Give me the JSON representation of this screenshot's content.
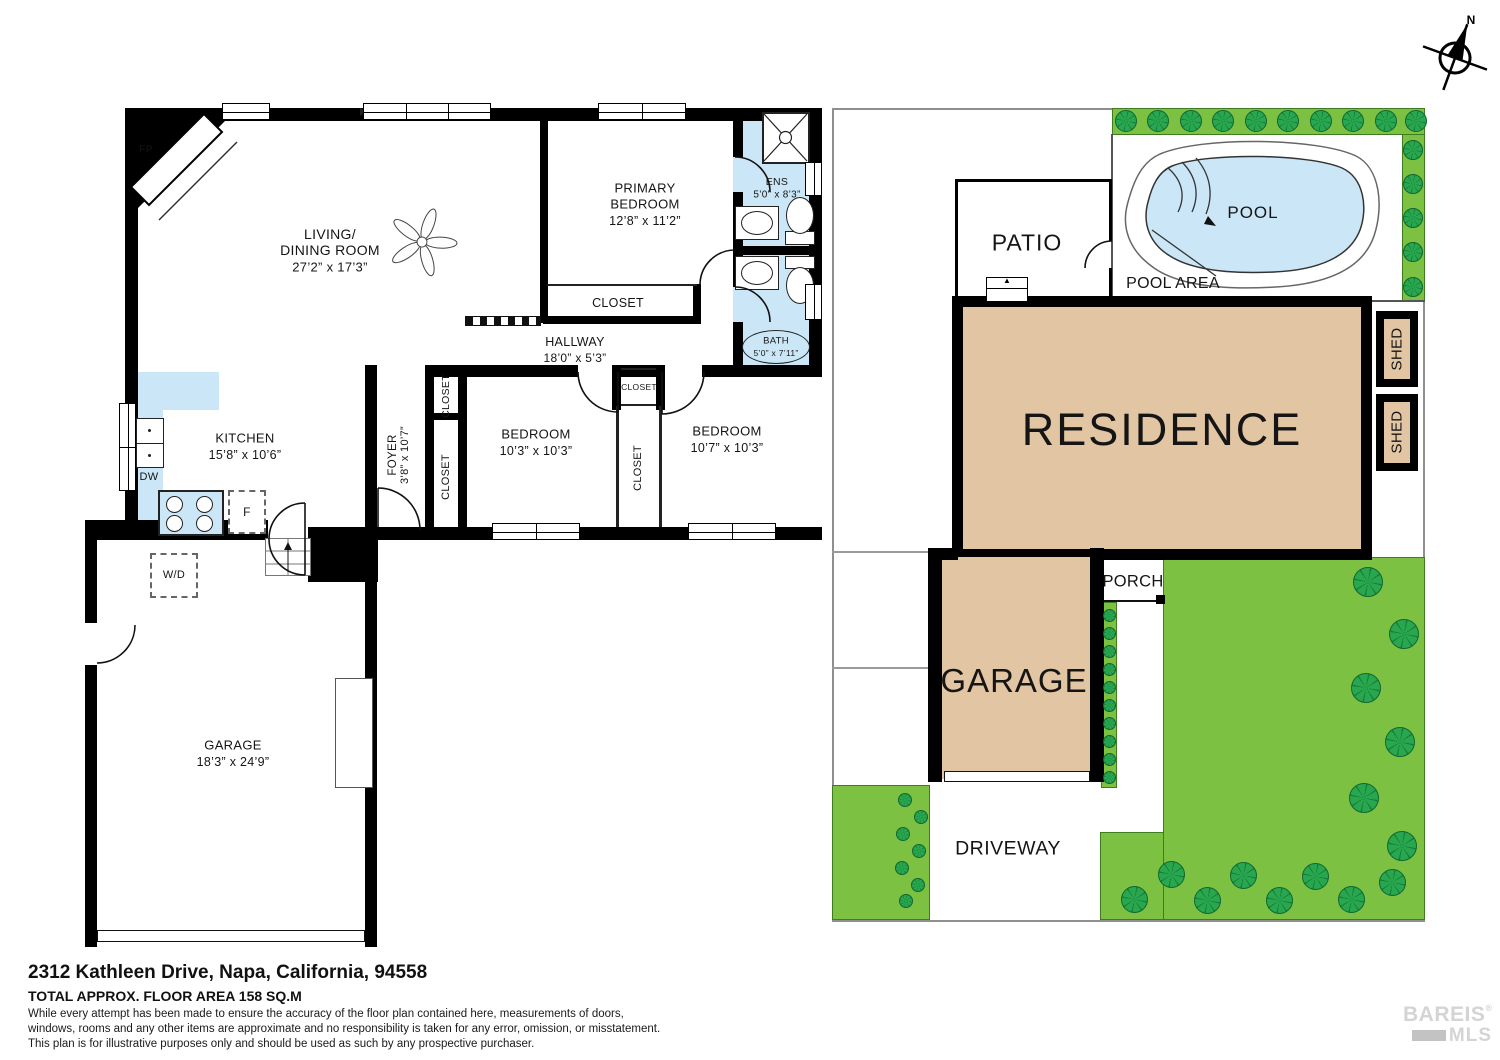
{
  "compass": {
    "north": "N"
  },
  "floorplan": {
    "fireplace": "FP",
    "living": {
      "l1": "LIVING/",
      "l2": "DINING ROOM",
      "dims": "27’2” x 17’3”"
    },
    "primary": {
      "l1": "PRIMARY",
      "l2": "BEDROOM",
      "dims": "12’8” x 11’2”"
    },
    "ens": {
      "name": "ENS",
      "dims": "5’0” x 8’3”"
    },
    "bath": {
      "name": "BATH",
      "dims": "5’0” x 7’11”"
    },
    "hallway": {
      "name": "HALLWAY",
      "dims": "18’0” x 5’3”"
    },
    "kitchen": {
      "name": "KITCHEN",
      "dims": "15’8” x 10’6”",
      "dishwasher": "DW",
      "fridge": "F"
    },
    "foyer": {
      "name": "FOYER",
      "dims": "3’8” x 10’7”"
    },
    "closet": "CLOSET",
    "bedroom1": {
      "name": "BEDROOM",
      "dims": "10’3” x 10’3”"
    },
    "bedroom2": {
      "name": "BEDROOM",
      "dims": "10’7” x 10’3”"
    },
    "washer_dryer": "W/D",
    "garage": {
      "name": "GARAGE",
      "dims": "18’3” x 24’9”"
    }
  },
  "siteplan": {
    "patio": "PATIO",
    "pool": "POOL",
    "pool_area": "POOL AREA",
    "residence": "RESIDENCE",
    "shed": "SHED",
    "porch": "PORCH",
    "garage": "GARAGE",
    "driveway": "DRIVEWAY"
  },
  "footer": {
    "address": "2312 Kathleen Drive, Napa, California, 94558",
    "area": "TOTAL APPROX. FLOOR AREA 158 SQ.M",
    "disclaimer": [
      "While  every attempt has been made to ensure the accuracy of the floor plan contained here, measurements of doors,",
      "windows, rooms and any other items are approximate and no responsibility is taken for any error, omission, or misstatement.",
      "This plan is for illustrative purposes only and should be used as such by any prospective purchaser."
    ]
  },
  "logo": {
    "brand": "BAREIS",
    "reg": "®",
    "suffix": "MLS"
  },
  "colors": {
    "water": "#cbe7f7",
    "structure": "#e2c5a3",
    "lawn": "#7cc142",
    "tree": "#28a74e",
    "wall": "#000000"
  }
}
